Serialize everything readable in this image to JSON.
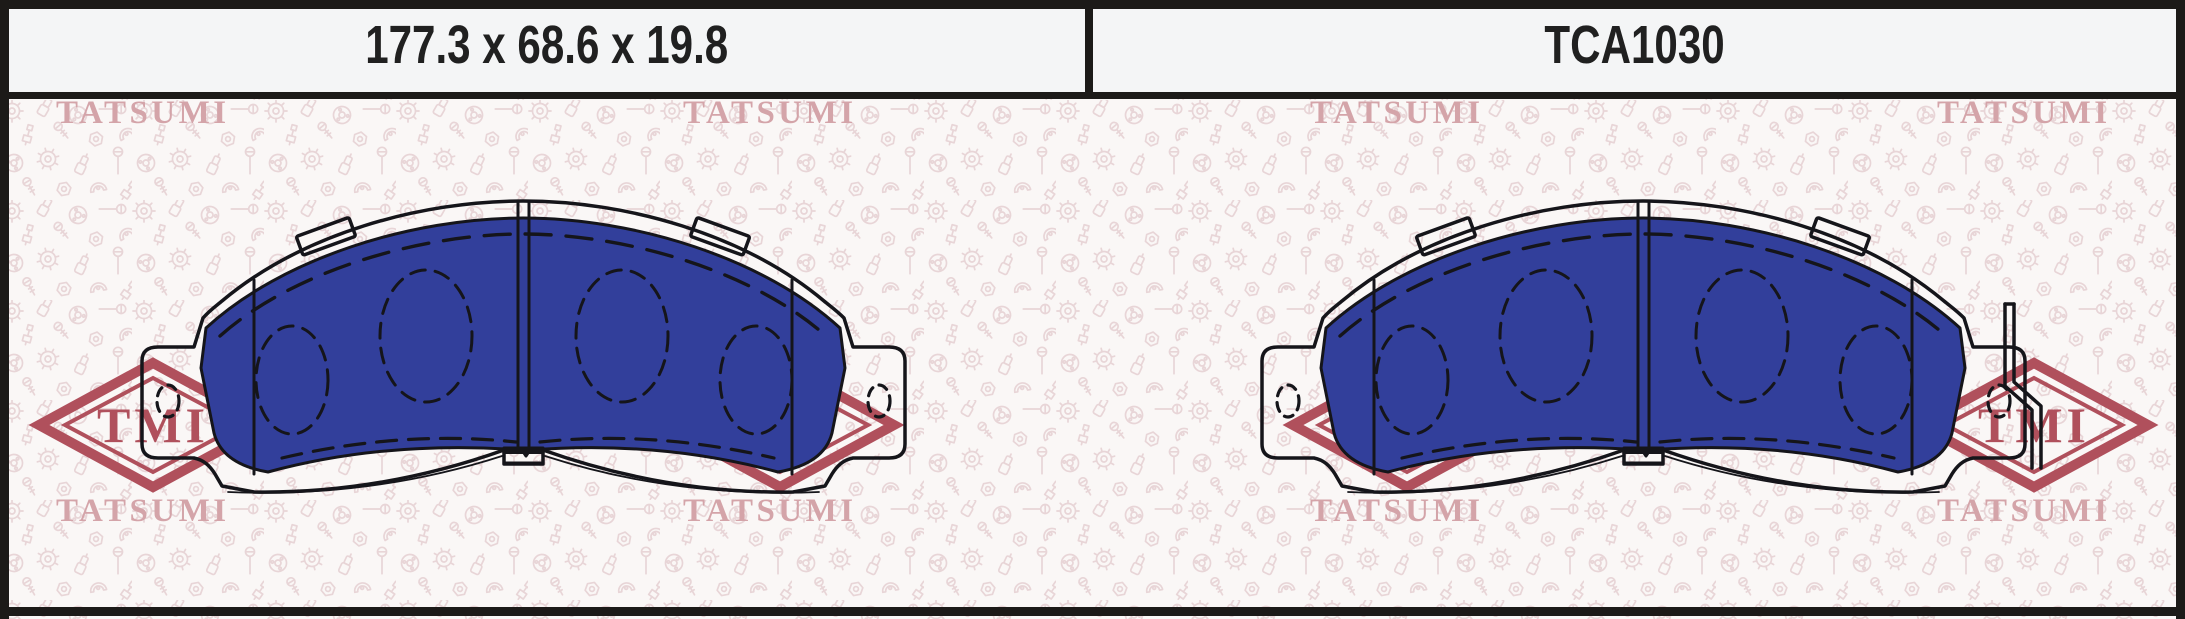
{
  "header": {
    "dimensions": "177.3 x 68.6 x 19.8",
    "part_number": "TCA1030"
  },
  "watermark": {
    "brand": "TATSUMI",
    "logo": "TMI"
  },
  "colors": {
    "pad_blue": "#323f9b",
    "drawing_outline": "#15151a",
    "logo_red": "#b0505c",
    "brand_pink": "#d4a4a9",
    "icon_pink": "#e8d5d7",
    "border_black": "#1c1a18",
    "header_bg": "#f4f5f6",
    "canvas_bg": "#faf7f6",
    "header_text": "#202020"
  }
}
